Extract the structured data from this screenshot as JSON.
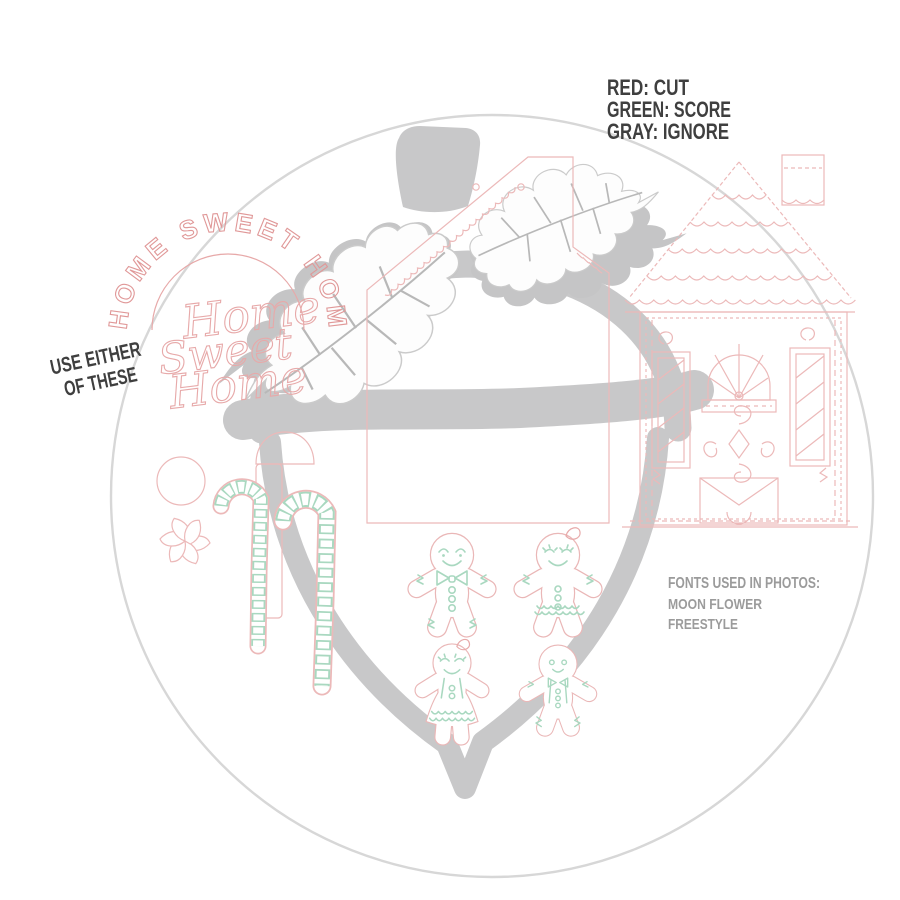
{
  "legend": {
    "red": "RED: CUT",
    "green": "GREEN: SCORE",
    "gray": "GRAY: IGNORE"
  },
  "notes": {
    "use_either_line1": "USE EITHER",
    "use_either_line2": "OF THESE",
    "fonts_title": "FONTS USED IN PHOTOS:",
    "fonts_line1": "MOON FLOWER",
    "fonts_line2": "FREESTYLE"
  },
  "design_texts": {
    "arc": "HOME SWEET HOME",
    "script1": "Home",
    "script2": "Sweet",
    "script3": "Home"
  },
  "colors": {
    "cut_red": "#e7a9a9",
    "score_green": "#a9d8c0",
    "ignore_gray": "#c8c8c9",
    "circle_gray": "#d7d7d7",
    "note_dark": "#3f3f3f",
    "note_gray": "#9b9b9b"
  }
}
